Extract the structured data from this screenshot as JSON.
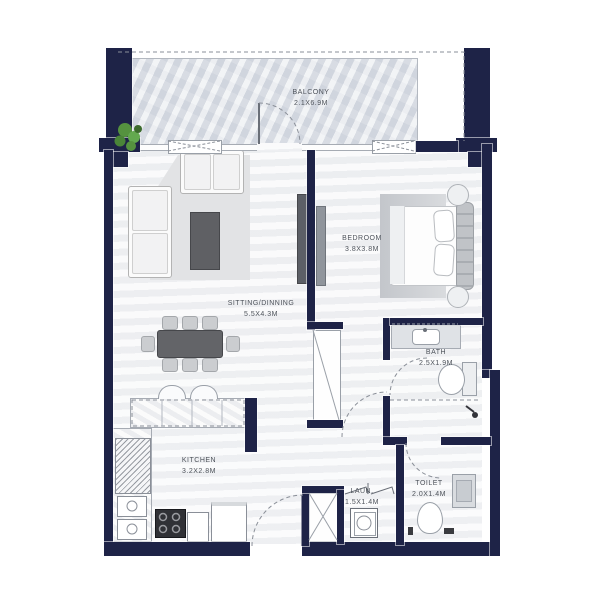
{
  "plan": {
    "type": "apartment-floor-plan",
    "background": "#ffffff",
    "wall_color": "#1e2347",
    "balcony_fill": "#dce0e7",
    "floor_fill": "#f3f4f6",
    "rooms": [
      {
        "id": "balcony",
        "name": "BALCONY",
        "dims": "2.1X6.9M"
      },
      {
        "id": "sitting_dining",
        "name": "SITTING/DINNING",
        "dims": "5.5X4.3M"
      },
      {
        "id": "bedroom",
        "name": "BEDROOM",
        "dims": "3.8X3.8M"
      },
      {
        "id": "bath",
        "name": "BATH",
        "dims": "2.5X1.9M"
      },
      {
        "id": "kitchen",
        "name": "KITCHEN",
        "dims": "3.2X2.8M"
      },
      {
        "id": "toilet",
        "name": "TOILET",
        "dims": "2.0X1.4M"
      },
      {
        "id": "laundry",
        "name": "LAUN.",
        "dims": "1.5X1.4M"
      }
    ],
    "icons": {
      "plant-icon": "green foliage cluster",
      "bed-icon": "double bed with pillows + tufted headboard",
      "sofa-icon": "L-shaped sectional sofa",
      "dining-table-icon": "8-seat dining table",
      "washer-icon": "washing machine square with drum circle",
      "stove-icon": "4-burner hob",
      "fridge-icon": "hatched tall unit",
      "wc-icon": "toilet bowl",
      "sink-icon": "basin",
      "shower-icon": "shower head",
      "door-arc-icon": "dashed quarter-circle door swing"
    }
  }
}
